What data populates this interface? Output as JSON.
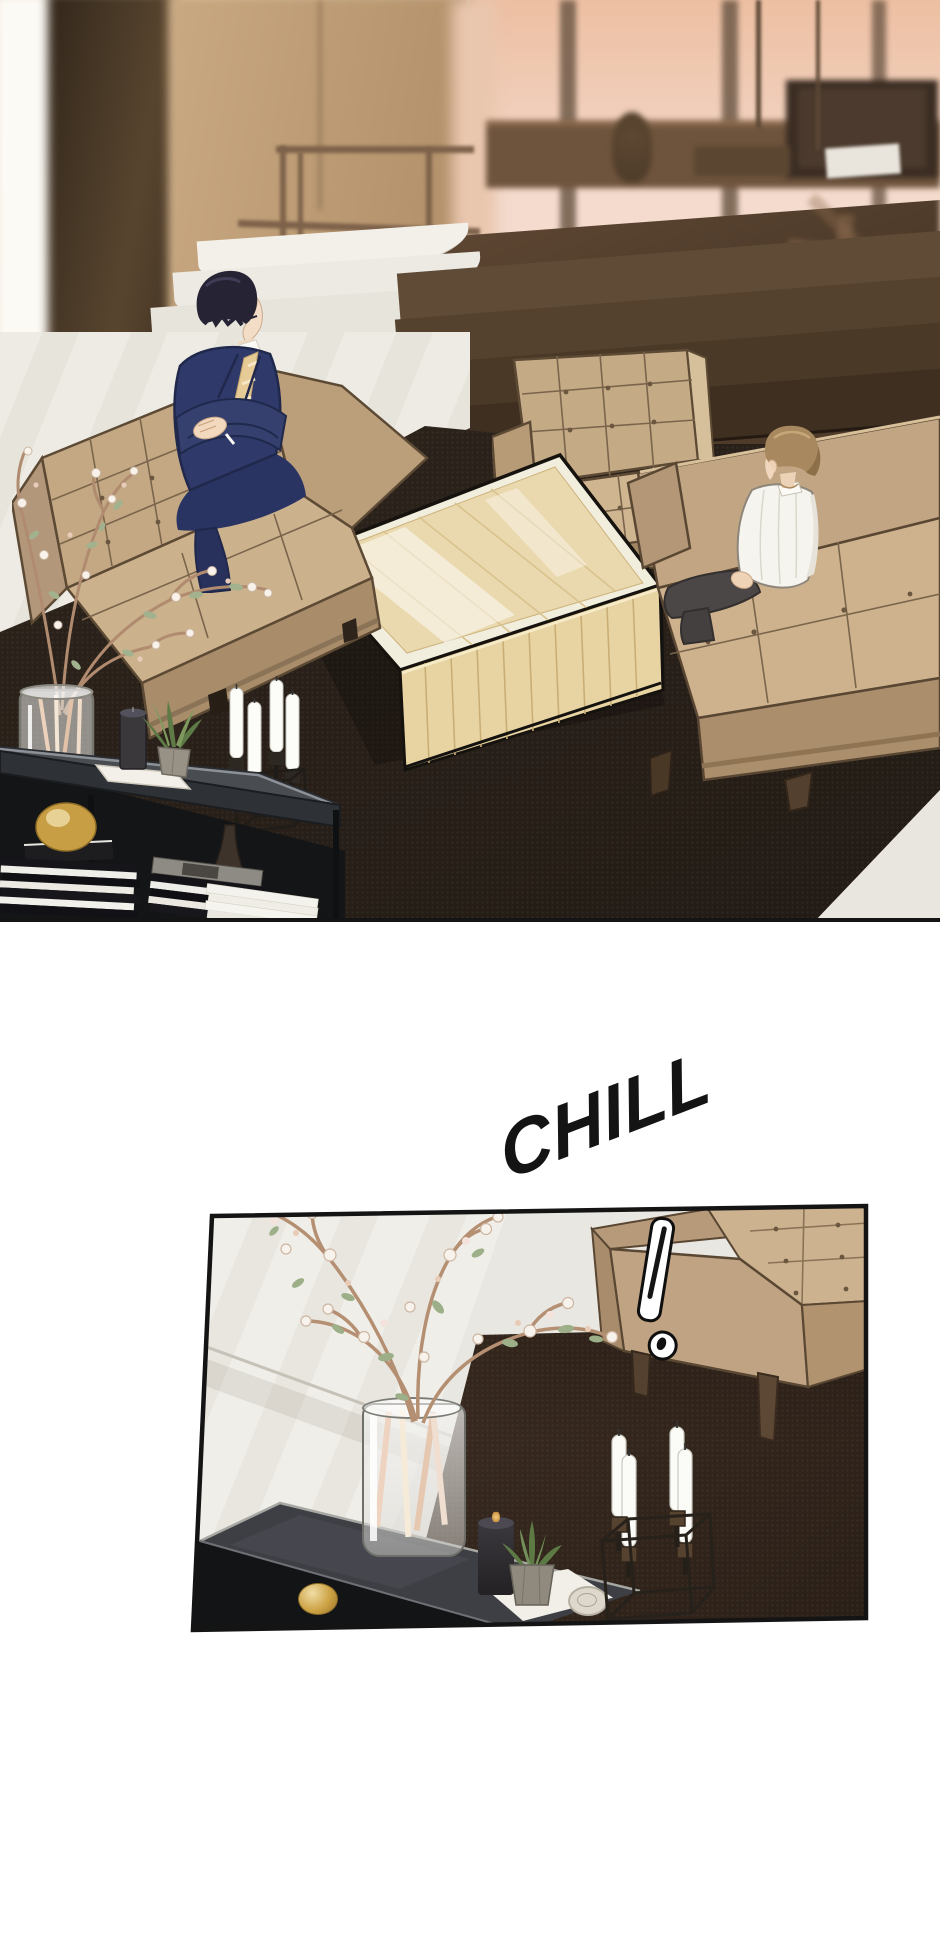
{
  "page": {
    "width": 940,
    "height": 1956,
    "background": "#ffffff"
  },
  "comic": {
    "type": "webtoon-episode-segment",
    "sfx": {
      "text": "CHILL",
      "color": "#141414"
    },
    "exclamation_mark": "!",
    "panels": [
      {
        "id": "panel-1",
        "label": "wide sunken-lounge scene at sunset",
        "objects": [
          "sunset window",
          "office desk",
          "monitor",
          "railing",
          "marble stairs",
          "dark wood steps",
          "pillar",
          "left sofa",
          "center armchair",
          "right sofa",
          "man in navy suit with gold tie",
          "man in white shirt",
          "coffee table",
          "dark area rug",
          "glass vase with blossom branches",
          "candelabra with white candles",
          "console table",
          "striped book stacks",
          "gold bowl",
          "black candle",
          "succulent",
          "white tray"
        ]
      },
      {
        "id": "panel-2",
        "label": "close-up of lounge corner",
        "objects": [
          "marble floor",
          "dark area rug",
          "beige sofa",
          "exclamation mark",
          "glass vase with blossom branches",
          "smoked-glass console table",
          "black candle",
          "succulent",
          "white tray with plate",
          "candelabra with white candles",
          "gold bowl"
        ]
      }
    ],
    "palette": {
      "ink": "#141414",
      "sofa_beige": "#c6ab87",
      "suit_navy": "#2f3a6a",
      "tie_gold": "#e6cb96",
      "rug_dark": "#2b221a",
      "rug_brown": "#3a2a1f",
      "marble": "#eceae2",
      "sunset": "#eec0a4",
      "table_wood": "#e8d4a2"
    }
  }
}
